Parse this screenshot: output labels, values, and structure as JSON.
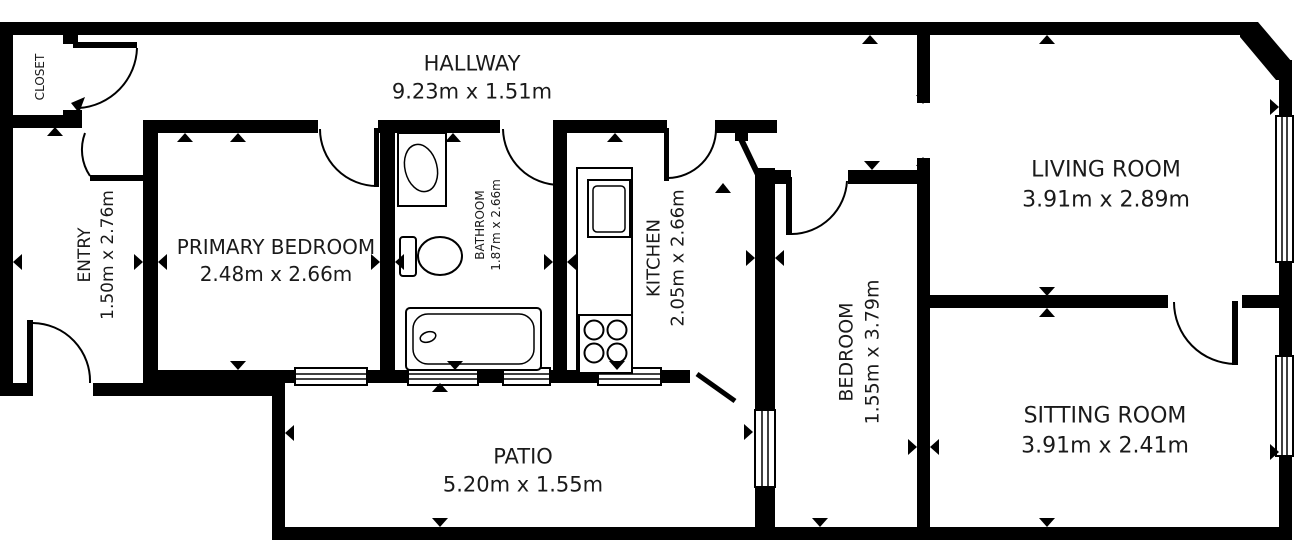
{
  "colors": {
    "walls": "#000000",
    "background": "#ffffff",
    "text": "#1a1a1a"
  },
  "rooms": [
    {
      "id": "closet",
      "name": "CLOSET",
      "dims": ""
    },
    {
      "id": "hallway",
      "name": "HALLWAY",
      "dims": "9.23m x 1.51m"
    },
    {
      "id": "entry",
      "name": "ENTRY",
      "dims": "1.50m x 2.76m"
    },
    {
      "id": "primary-bedroom",
      "name": "PRIMARY BEDROOM",
      "dims": "2.48m x 2.66m"
    },
    {
      "id": "bathroom",
      "name": "BATHROOM",
      "dims": "1.87m x 2.66m"
    },
    {
      "id": "kitchen",
      "name": "KITCHEN",
      "dims": "2.05m x 2.66m"
    },
    {
      "id": "living-room",
      "name": "LIVING ROOM",
      "dims": "3.91m x 2.89m"
    },
    {
      "id": "bedroom",
      "name": "BEDROOM",
      "dims": "1.55m x 3.79m"
    },
    {
      "id": "sitting-room",
      "name": "SITTING ROOM",
      "dims": "3.91m x 2.41m"
    },
    {
      "id": "patio",
      "name": "PATIO",
      "dims": "5.20m x 1.55m"
    }
  ],
  "fixtures": [
    "bathroom-sink",
    "toilet",
    "bathtub",
    "kitchen-counter",
    "oven",
    "stove-burners"
  ]
}
